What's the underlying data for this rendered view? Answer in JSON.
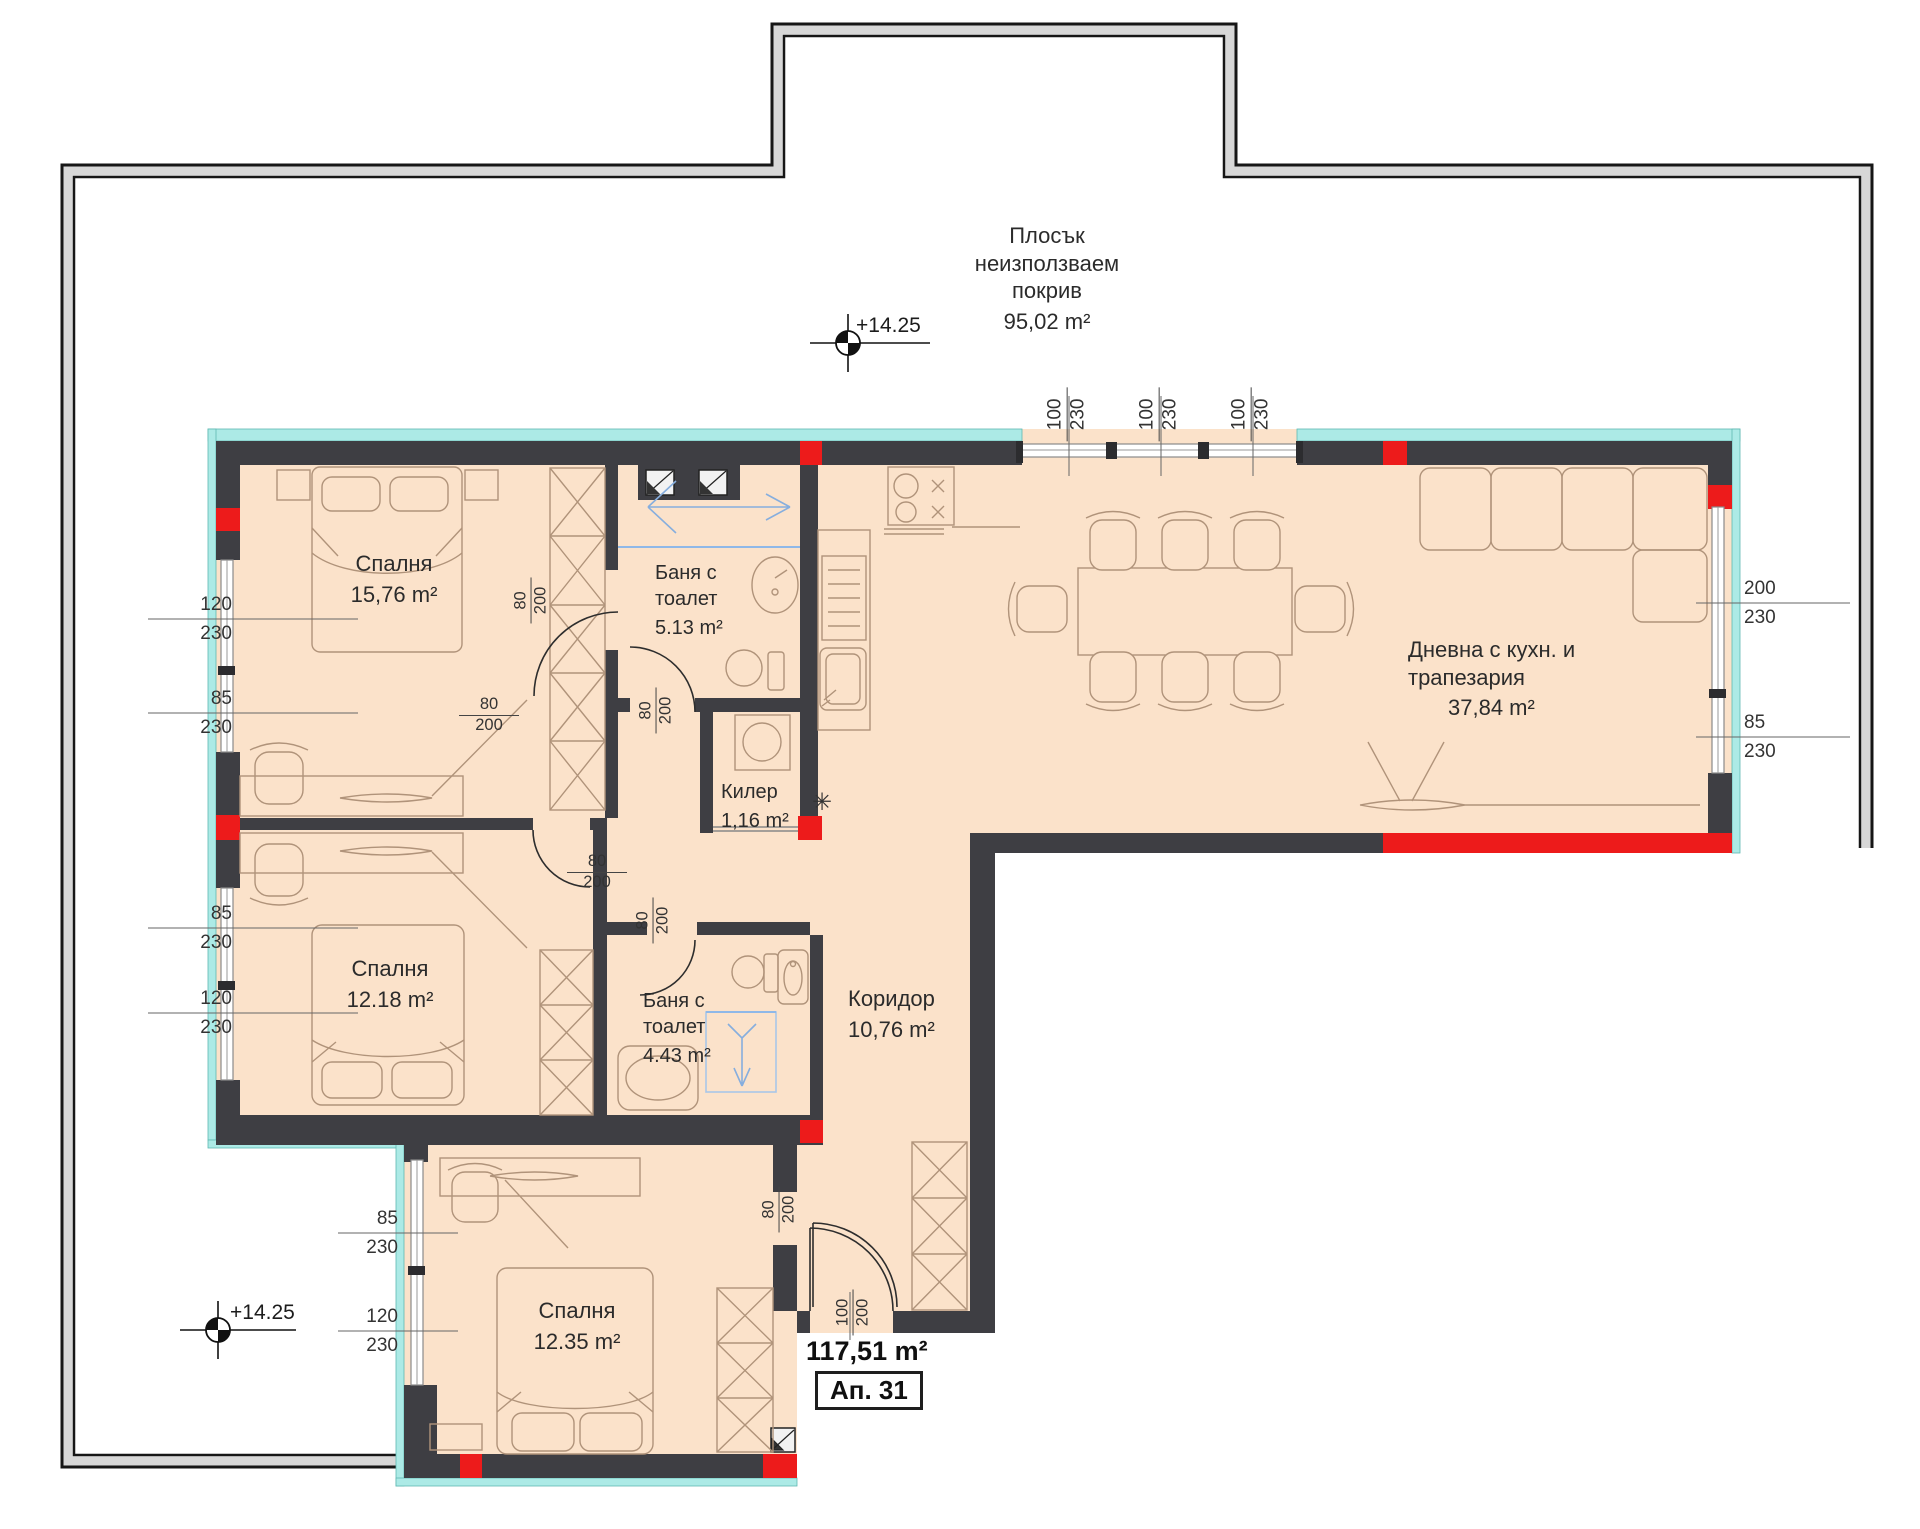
{
  "roof": {
    "line1": "Плосък",
    "line2": "неизползваем",
    "line3": "покрив",
    "area": "95,02 m²"
  },
  "elevations": {
    "top": "+14.25",
    "bottom": "+14.25"
  },
  "rooms": {
    "bedroom1": {
      "name": "Спалня",
      "area": "15,76 m²"
    },
    "bath1": {
      "name1": "Баня с",
      "name2": "тоалет",
      "area": "5.13 m²"
    },
    "storage": {
      "name": "Килер",
      "area": "1,16 m²"
    },
    "living": {
      "name1": "Дневна с кухн. и",
      "name2": "трапезария",
      "area": "37,84 m²"
    },
    "bedroom2": {
      "name": "Спалня",
      "area": "12.18 m²"
    },
    "bath2": {
      "name1": "Баня с",
      "name2": "тоалет",
      "area": "4.43 m²"
    },
    "corridor": {
      "name": "Коридор",
      "area": "10,76 m²"
    },
    "bedroom3": {
      "name": "Спалня",
      "area": "12.35 m²"
    }
  },
  "summary": {
    "total_area": "117,51 m²",
    "apartment_no": "Ап. 31"
  },
  "dims": {
    "left": [
      {
        "w": "120",
        "h": "230"
      },
      {
        "w": "85",
        "h": "230"
      },
      {
        "w": "85",
        "h": "230"
      },
      {
        "w": "120",
        "h": "230"
      },
      {
        "w": "85",
        "h": "230"
      },
      {
        "w": "120",
        "h": "230"
      }
    ],
    "right": [
      {
        "w": "200",
        "h": "230"
      },
      {
        "w": "85",
        "h": "230"
      }
    ],
    "top_windows": [
      {
        "w": "100",
        "h": "230"
      },
      {
        "w": "100",
        "h": "230"
      },
      {
        "w": "100",
        "h": "230"
      }
    ],
    "doors": [
      {
        "w": "80",
        "h": "200"
      },
      {
        "w": "80",
        "h": "200"
      },
      {
        "w": "80",
        "h": "200"
      },
      {
        "w": "80",
        "h": "200"
      },
      {
        "w": "80",
        "h": "200"
      },
      {
        "w": "80",
        "h": "200"
      }
    ],
    "entrance_door": {
      "w": "100",
      "h": "200"
    }
  },
  "symbols": {
    "vent": "✳"
  },
  "colors": {
    "wall": "#3e3e43",
    "accent_red": "#ed1b1b",
    "floor": "#fbe2ca",
    "window_band": "#aceae6",
    "glass_blue": "#8fb8e8"
  }
}
